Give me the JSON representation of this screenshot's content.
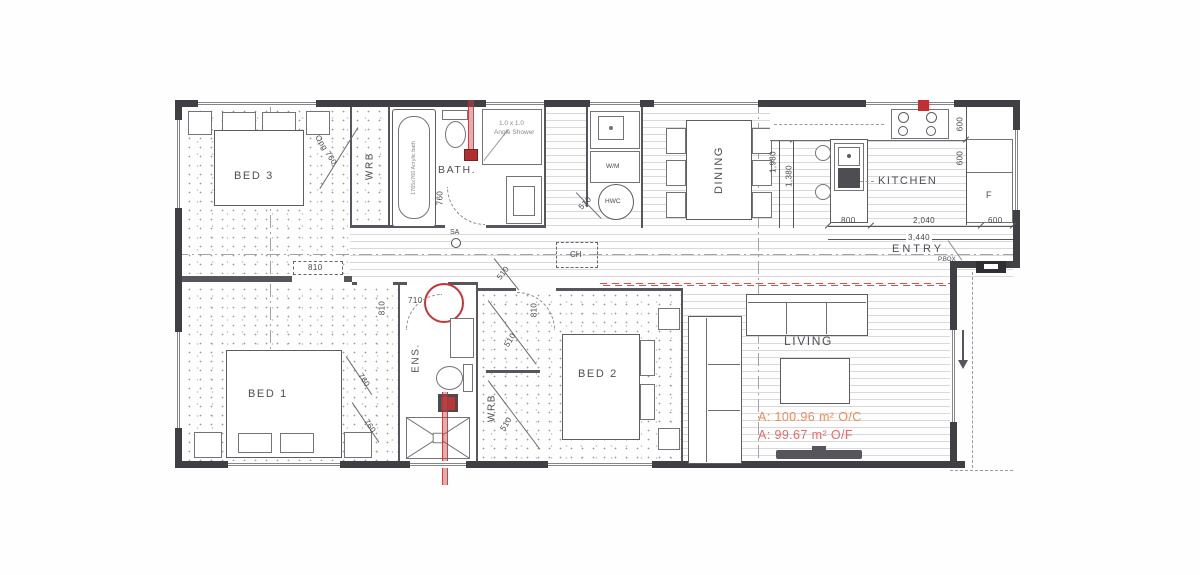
{
  "rooms": {
    "bed3": "BED 3",
    "wrb1": "WRB",
    "bath": "BATH.",
    "dining": "DINING",
    "kitchen": "KITCHEN",
    "entry": "ENTRY",
    "bed1": "BED 1",
    "ens": "ENS.",
    "wrb2": "WRB",
    "bed2": "BED 2",
    "living": "LIVING"
  },
  "fixtures": {
    "acrylic_bath": "1765x760 Acrylic bath",
    "angle_shower_line1": "1.0 x 1.0",
    "angle_shower_line2": "Angle Shower",
    "washing_machine": "W/M",
    "hot_water_cylinder": "HWC",
    "fridge": "F",
    "smoke_alarm": "SA",
    "ceiling_hatch": "CH",
    "power_box": "P.BOX"
  },
  "dimensions": {
    "bed3_door": "Opg 760",
    "bed3_opening": "810",
    "bath_door": "760",
    "hwc_door": "510",
    "hall_door": "510",
    "bed1_door": "810",
    "ens_door": "710",
    "bed1_robe_a": "760",
    "bed1_robe_b": "760",
    "bed2_door": "810",
    "wrb2_slider_a": "510",
    "wrb2_slider_b": "510",
    "kitchen_top_a": "600",
    "kitchen_top_b": "600",
    "dining_upper": "600",
    "dining_total": "1,980",
    "dining_lower": "1,380",
    "kitchen_row_a": "800",
    "kitchen_row_b": "2,040",
    "kitchen_row_c": "600",
    "kitchen_row_total": "3,440"
  },
  "areas": {
    "over_cladding": "A: 100.96 m² O/C",
    "over_framing": "A: 99.67 m² O/F"
  },
  "colors": {
    "wall": "#3f3f44",
    "annotation_red": "#c63535",
    "area_orange": "#f08b5a",
    "area_red": "#ea6868"
  }
}
